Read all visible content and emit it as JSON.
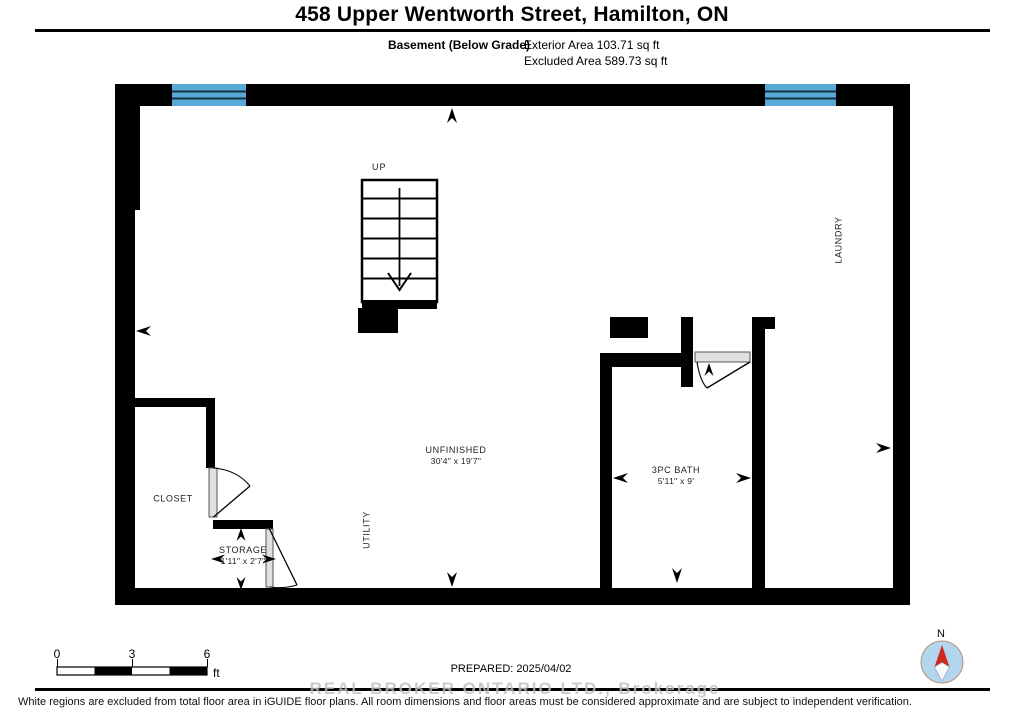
{
  "header": {
    "title": "458 Upper Wentworth Street, Hamilton, ON",
    "floor_label": "Basement (Below Grade)",
    "exterior_area": "Exterior Area 103.71 sq ft",
    "excluded_area": "Excluded Area 589.73 sq ft"
  },
  "plan": {
    "stairs_label": "UP",
    "rooms": {
      "unfinished": {
        "name": "UNFINISHED",
        "dims": "30'4\" x 19'7\""
      },
      "bath": {
        "name": "3PC BATH",
        "dims": "5'11\" x 9'"
      },
      "closet": {
        "name": "CLOSET"
      },
      "storage": {
        "name": "STORAGE",
        "dims": "1'11\" x 2'7\""
      },
      "laundry": {
        "name": "LAUNDRY"
      },
      "utility": {
        "name": "UTILITY"
      }
    },
    "colors": {
      "wall": "#000000",
      "window": "#58a8d8",
      "door": "#e0e0e0"
    }
  },
  "footer": {
    "scale_bar": {
      "tick_0": "0",
      "tick_3": "3",
      "tick_6": "6",
      "unit": "ft"
    },
    "prepared": "PREPARED: 2025/04/02",
    "watermark": "REAL BROKER ONTARIO LTD., Brokerage",
    "disclaimer": "White regions are excluded from total floor area in iGUIDE floor plans. All room dimensions and floor areas must be considered approximate and are subject to independent verification.",
    "compass": {
      "north_label": "N"
    }
  }
}
